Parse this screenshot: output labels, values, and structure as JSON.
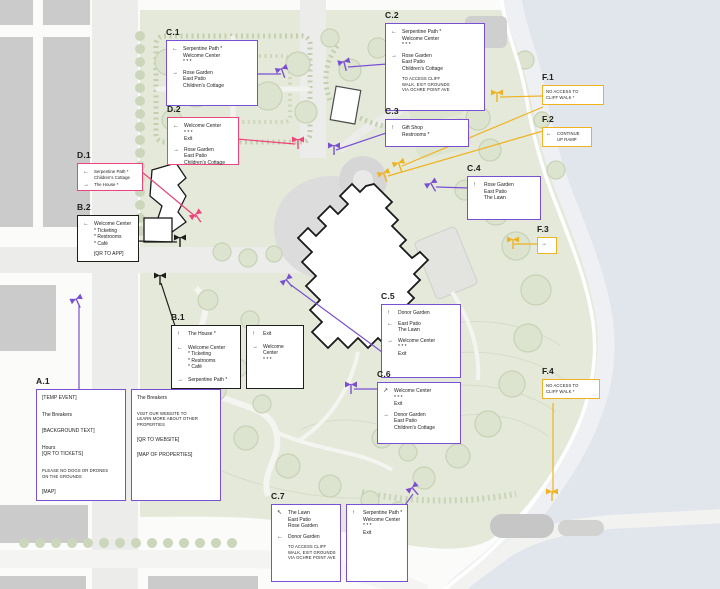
{
  "colors": {
    "purple": "#7a50d3",
    "pink": "#ef447b",
    "black": "#1d1d1b",
    "yellow": "#f0b21f",
    "water": "#e1e5ec",
    "grass": "#e4e9da"
  },
  "callouts": {
    "a1": {
      "id": "A.1",
      "box1": {
        "l1": "[TEMP EVENT]",
        "l2": "The Breakers",
        "l3": "[BACKGROUND TEXT]",
        "l4": "Hours\n[QR TO TICKETS]",
        "l5": "PLEASE NO DOGS OR DRONES\nON THE GROUNDS",
        "l6": "[MAP]"
      },
      "box2": {
        "l1": "The Breakers",
        "l2": "VISIT OUR WEBSITE TO\nLEARN MORE ABOUT OTHER\nPROPERTIES",
        "l3": "[QR TO WEBSITE]",
        "l4": "[MAP OF PROPERTIES]"
      }
    },
    "b1": {
      "id": "B.1",
      "box1": {
        "i1": {
          "arrow": "↑",
          "text": "The House *"
        },
        "i2": {
          "arrow": "←",
          "text": "Welcome Center\n* Ticketing\n* Restrooms\n* Café"
        },
        "i3": {
          "arrow": "→",
          "text": "Serpentine Path *"
        }
      },
      "box2": {
        "i1": {
          "arrow": "↑",
          "text": "Exit"
        },
        "i2": {
          "arrow": "→",
          "text": "Welcome Center\n* * *"
        }
      }
    },
    "b2": {
      "id": "B.2",
      "i1": {
        "arrow": "←",
        "text": "Welcome Center\n* Ticketing\n* Restrooms\n* Café"
      },
      "note": "[QR TO APP]"
    },
    "c1": {
      "id": "C.1",
      "i1": {
        "arrow": "←",
        "text": "Serpentine Path *\nWelcome Center\n* * *"
      },
      "i2": {
        "arrow": "→",
        "text": "Rose Garden\nEast Patio\nChildren's Cottage"
      }
    },
    "c2": {
      "id": "C.2",
      "i1": {
        "arrow": "←",
        "text": "Serpentine Path *\nWelcome Center\n* * *"
      },
      "i2": {
        "arrow": "→",
        "text": "Rose Garden\nEast Patio\nChildren's Cottage"
      },
      "note": "TO ACCESS CLIFF\nWALK, EXIT GROUNDS\nVIA OCHRE POINT AVE"
    },
    "c3": {
      "id": "C.3",
      "i1": {
        "arrow": "↑",
        "text": "Gift Shop\nRestrooms *"
      }
    },
    "c4": {
      "id": "C.4",
      "i1": {
        "arrow": "↑",
        "text": "Rose Garden\nEast Patio\nThe Lawn"
      }
    },
    "c5": {
      "id": "C.5",
      "i1": {
        "arrow": "↑",
        "text": "Donor Garden"
      },
      "i2": {
        "arrow": "←",
        "text": "East Patio\nThe Lawn"
      },
      "i3": {
        "arrow": "→",
        "text": "Welcome Center\n* * *\nExit"
      }
    },
    "c6": {
      "id": "C.6",
      "i1": {
        "arrow": "↗",
        "text": "Welcome Center\n* * *\nExit"
      },
      "i2": {
        "arrow": "→",
        "text": "Donor Garden\nEast Patio\nChildren's Cottage"
      }
    },
    "c7": {
      "id": "C.7",
      "box1": {
        "i1": {
          "arrow": "↖",
          "text": "The Lawn\nEast Patio\nRose Garden"
        },
        "i2": {
          "arrow": "←",
          "text": "Donor Garden"
        },
        "note": "TO ACCESS CLIFF\nWALK, EXIT GROUNDS\nVIA OCHRE POINT AVE"
      },
      "box2": {
        "i1": {
          "arrow": "↑",
          "text": "Serpentine Path *\nWelcome Center\n* * *\nExit"
        }
      }
    },
    "d1": {
      "id": "D.1",
      "i1": {
        "arrow": "←",
        "text": "Serpentine Path *\nChildren's Cottage"
      },
      "i2": {
        "arrow": "→",
        "text": "The House *"
      }
    },
    "d2": {
      "id": "D.2",
      "i1": {
        "arrow": "←",
        "text": "Welcome Center\n* * *\nExit"
      },
      "i2": {
        "arrow": "→",
        "text": "Rose Garden\nEast Patio\nChildren's Cottage"
      }
    },
    "f1": {
      "id": "F.1",
      "note": "NO ACCESS TO\nCLIFF WALK *"
    },
    "f2": {
      "id": "F.2",
      "i1": {
        "arrow": "←",
        "text": "CONTINUE\nUP RAMP"
      }
    },
    "f3": {
      "id": "F.3",
      "i1": {
        "arrow": "→",
        "text": ""
      }
    },
    "f4": {
      "id": "F.4",
      "note": "NO ACCESS TO\nCLIFF WALK *"
    }
  }
}
